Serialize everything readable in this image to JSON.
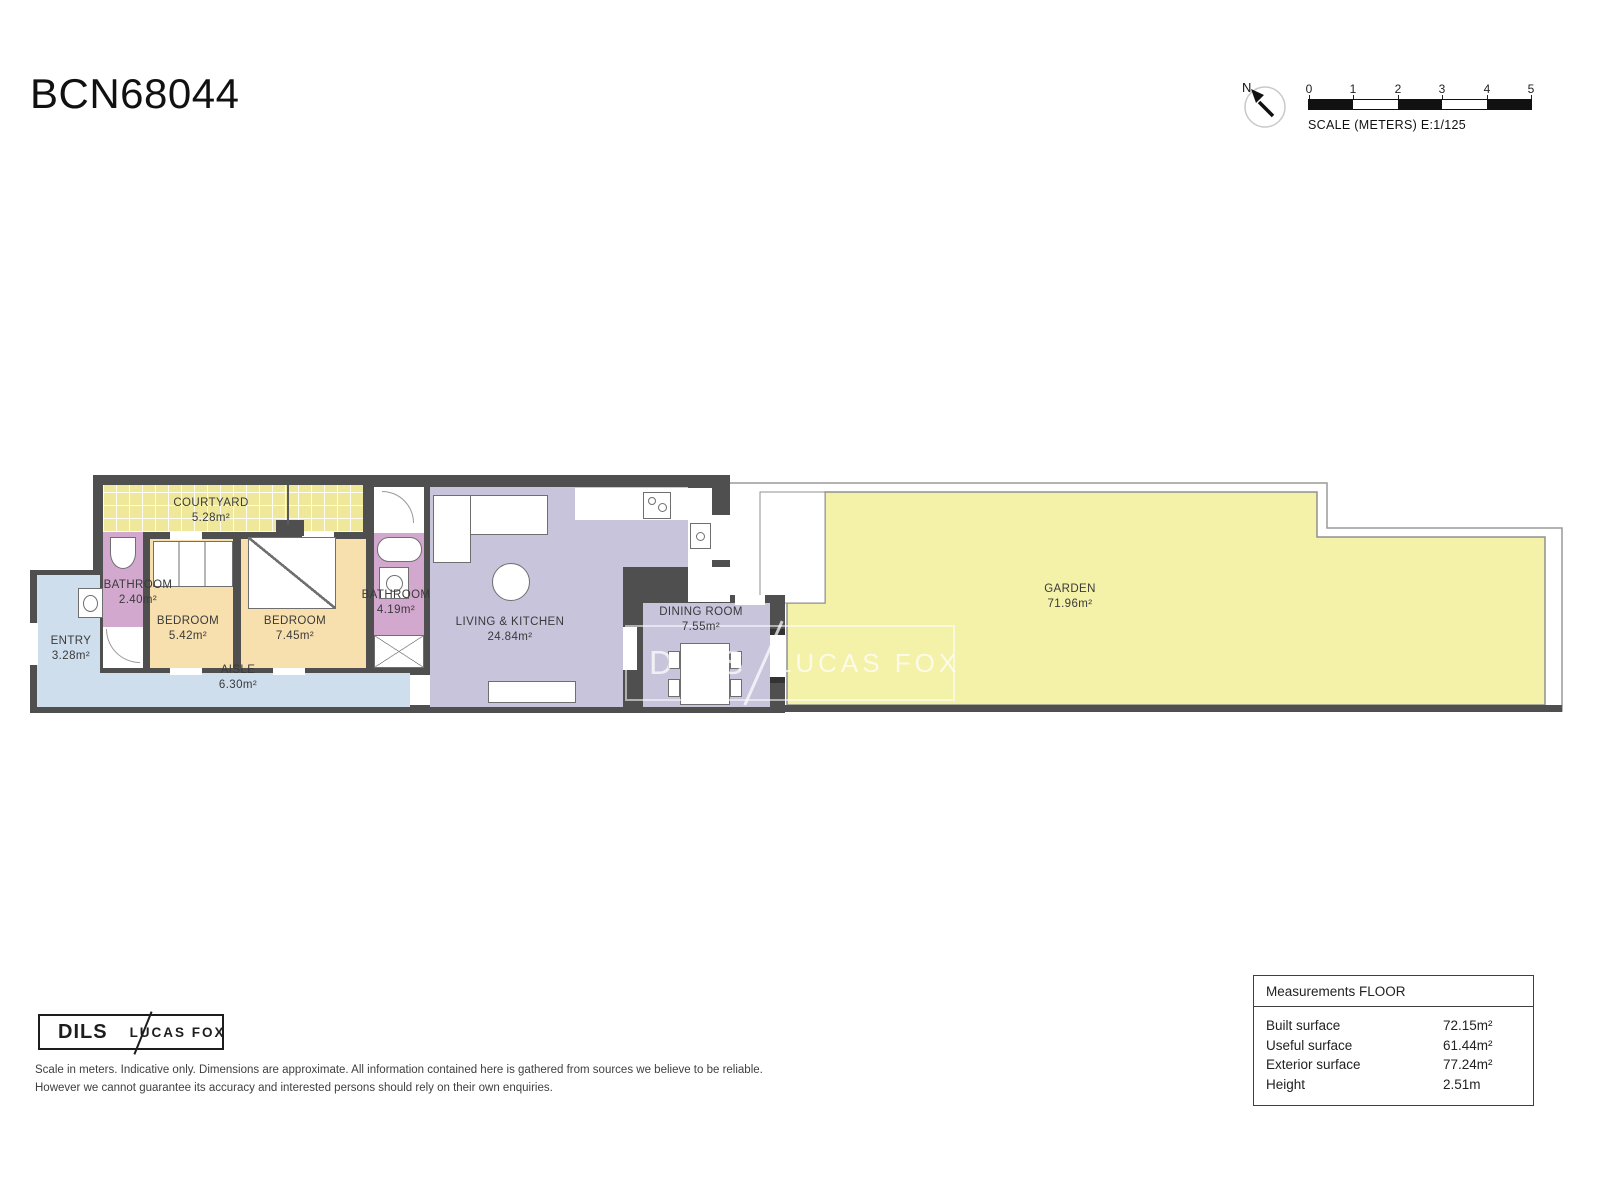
{
  "title": "BCN68044",
  "compass": {
    "north_label": "N"
  },
  "scale_bar": {
    "ticks": [
      "0",
      "1",
      "2",
      "3",
      "4",
      "5"
    ],
    "caption": "SCALE (METERS) E:1/125"
  },
  "rooms": {
    "courtyard": {
      "name": "COURTYARD",
      "area": "5.28m²"
    },
    "bathroom_small": {
      "name": "BATHROOM",
      "area": "2.40m²"
    },
    "bedroom_small": {
      "name": "BEDROOM",
      "area": "5.42m²"
    },
    "bedroom_large": {
      "name": "BEDROOM",
      "area": "7.45m²"
    },
    "bathroom_large": {
      "name": "BATHROOM",
      "area": "4.19m²"
    },
    "entry": {
      "name": "ENTRY",
      "area": "3.28m²"
    },
    "aisle": {
      "name": "AISLE",
      "area": "6.30m²"
    },
    "living_kitchen": {
      "name": "LIVING & KITCHEN",
      "area": "24.84m²"
    },
    "dining_room": {
      "name": "DINING ROOM",
      "area": "7.55m²"
    },
    "garden": {
      "name": "GARDEN",
      "area": "71.96m²"
    }
  },
  "watermark": {
    "brand_left": "DILS",
    "brand_right": "LUCAS FOX"
  },
  "footer_logo": {
    "brand_left": "DILS",
    "brand_right": "LUCAS FOX"
  },
  "measurements": {
    "header": "Measurements FLOOR",
    "rows": [
      {
        "label": "Built surface",
        "value": "72.15m²"
      },
      {
        "label": "Useful surface",
        "value": "61.44m²"
      },
      {
        "label": "Exterior surface",
        "value": "77.24m²"
      },
      {
        "label": "Height",
        "value": "2.51m"
      }
    ]
  },
  "disclaimer": {
    "line1": "Scale in meters. Indicative only. Dimensions are approximate. All information contained here is gathered from sources we believe to be reliable.",
    "line2": "However we cannot guarantee its accuracy and interested persons should rely on their own enquiries."
  },
  "colors": {
    "wall": "#4f4f4f",
    "courtyard": "#efe89a",
    "garden": "#f4f1a9",
    "bedroom": "#f8dfae",
    "bathroom": "#d3a8ce",
    "hall": "#cfdeed",
    "living": "#c7c4dc",
    "boundary": "#909090",
    "label_text": "#3a3a3a"
  }
}
